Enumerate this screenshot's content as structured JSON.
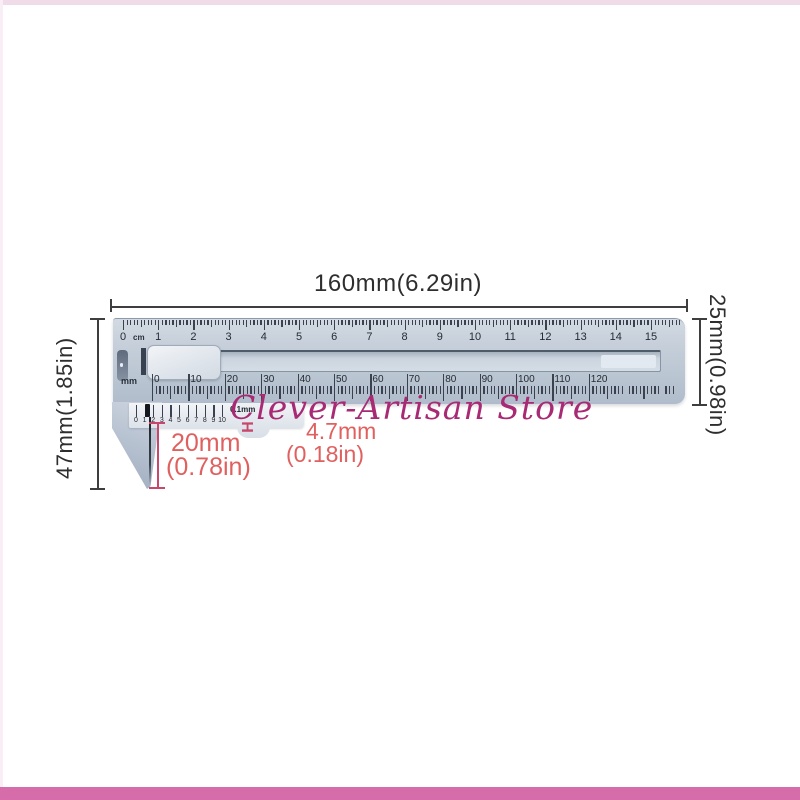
{
  "watermark": {
    "text": "Clever-Artisan Store",
    "color": "#a82a74"
  },
  "dimensions": {
    "length": "160mm(6.29in)",
    "height_right": "25mm(0.98in)",
    "height_left": "47mm(1.85in)",
    "jaw_depth": {
      "value": "20mm",
      "inches": "(0.78in)"
    },
    "probe_width": {
      "value": "4.7mm",
      "inches": "(0.18in)"
    }
  },
  "caliper": {
    "cm_scale": {
      "unit": "cm",
      "labels": [
        "0",
        "1",
        "2",
        "3",
        "4",
        "5",
        "6",
        "7",
        "8",
        "9",
        "10",
        "11",
        "12",
        "13",
        "14",
        "15"
      ],
      "minor_per_major": 10
    },
    "mm_scale": {
      "unit": "mm",
      "labels": [
        "0",
        "10",
        "20",
        "30",
        "40",
        "50",
        "60",
        "70",
        "80",
        "90",
        "100",
        "110",
        "120"
      ]
    },
    "vernier_scale": {
      "labels": [
        "0",
        "1",
        "2",
        "3",
        "4",
        "5",
        "6",
        "7",
        "8",
        "9",
        "10"
      ],
      "precision": "0.1mm"
    },
    "probe_marker_glyph": "H"
  },
  "colors": {
    "frame_pink": "#d76cab",
    "annotation_red": "#e0605f",
    "annotation_red_line": "#c8476a",
    "dimension_line": "#3e3e3e",
    "watermark_magenta": "#a82a74",
    "caliper_body": "#c2ccd8"
  }
}
